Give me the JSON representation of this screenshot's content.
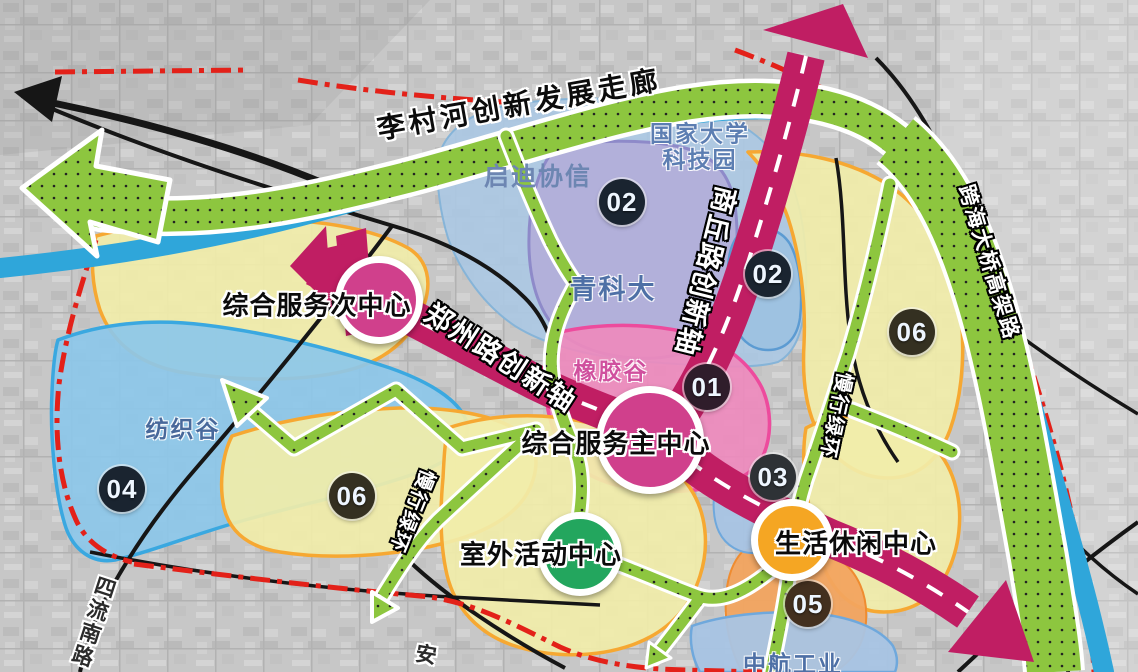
{
  "map": {
    "corridor": {
      "label": "李村河创新发展走廊"
    },
    "axes": {
      "shangqiu": "商丘路创新轴",
      "zhengzhou": "郑州路创新轴"
    },
    "ring": "慢行绿环",
    "roads": {
      "elevated": "跨海大桥高架路",
      "siliu_south": "四流南路",
      "an": "安"
    },
    "centers": [
      {
        "label": "综合服务次中心",
        "color": "#d0408c"
      },
      {
        "label": "综合服务主中心",
        "color": "#d0408c"
      },
      {
        "label": "室外活动中心",
        "color": "#23a65e"
      },
      {
        "label": "生活休闲中心",
        "color": "#f5a623"
      }
    ],
    "zones": {
      "qidi": "启迪协信",
      "guojia": "国家大学\n科技园",
      "qingkeda": "青科大",
      "xiangjiao": "橡胶谷",
      "fangzhi": "纺织谷",
      "zhonghang": "中航工业"
    },
    "badges": [
      "02",
      "02",
      "06",
      "01",
      "03",
      "04",
      "06",
      "05"
    ]
  },
  "colors": {
    "axis_magenta": "#c01e63",
    "green_corridor": "#8dc63f",
    "river_blue": "#2fa6da",
    "zone_yellow": "#f1eda9",
    "zone_yellow_border": "#f6a832",
    "zone_blue": "#8cc7e9",
    "zone_blue_border": "#3aa8e0",
    "zone_lightblue": "#abc8e3",
    "zone_purple": "#b2aed9",
    "zone_purple_border": "#8e8ac9",
    "zone_pink": "#ee8abd",
    "zone_pink_border": "#ed4b9d",
    "zone_orange": "#f2a45f",
    "boundary_red": "#e32119",
    "center_magenta": "#d0408c",
    "center_green": "#23a65e",
    "center_orange": "#f5a623",
    "badge_navy": "#1a2430",
    "badge_plum": "#2f1d2b",
    "badge_charcoal": "#2e3236",
    "badge_brown": "#43301f",
    "badge_olive": "#343021"
  }
}
